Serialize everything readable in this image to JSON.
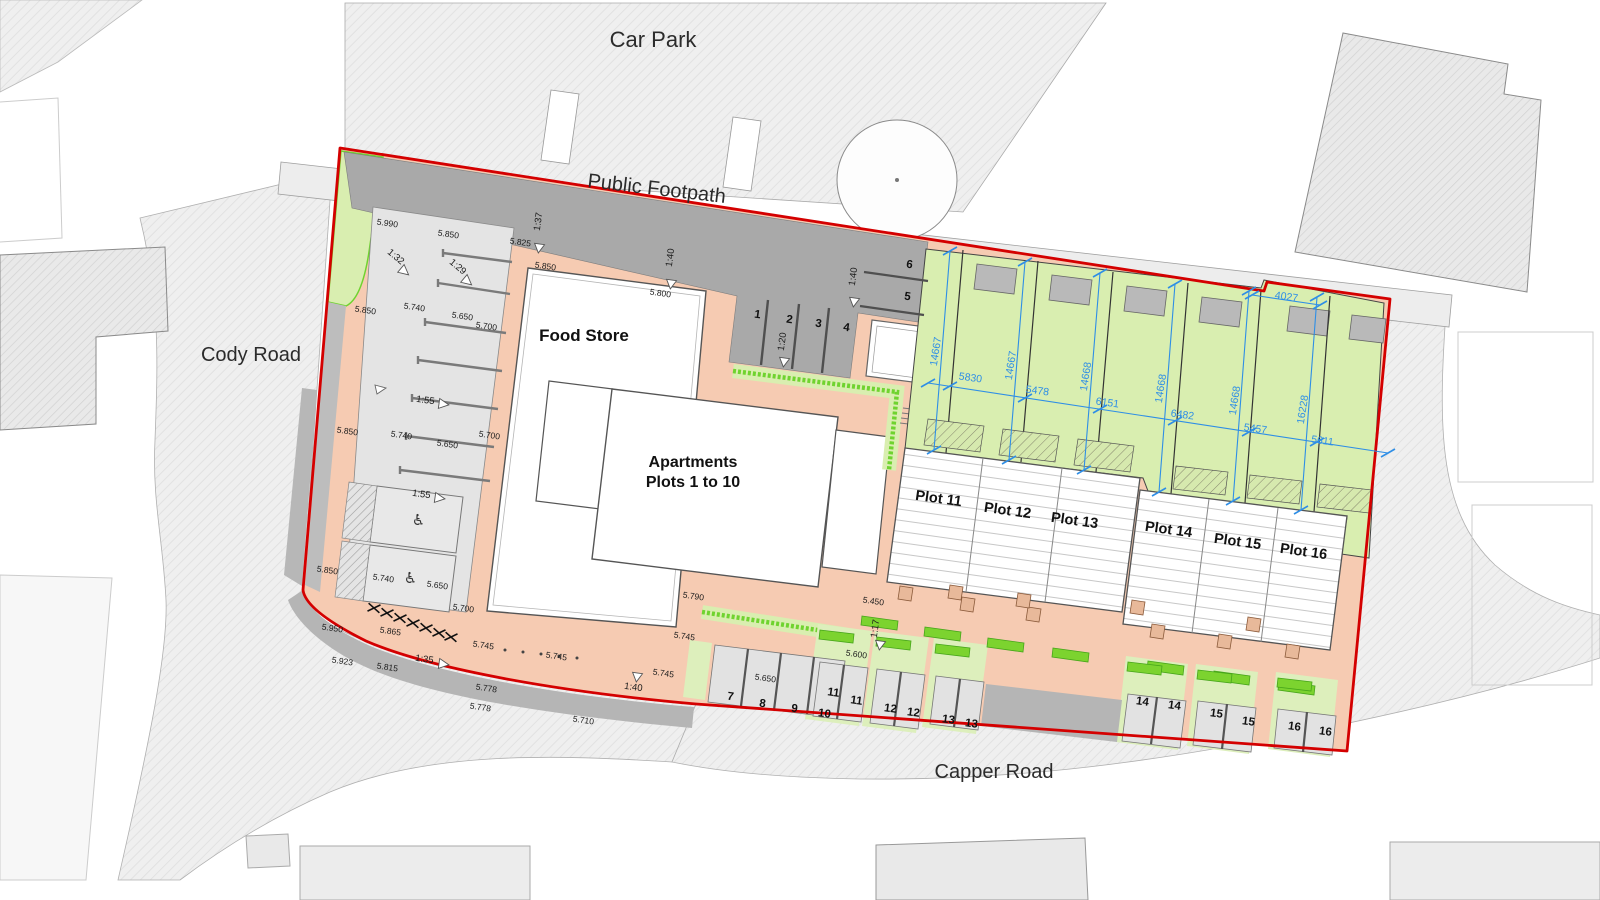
{
  "drawing": {
    "type": "site-layout-plan",
    "roads": {
      "car_park": "Car Park",
      "public_footpath": "Public Footpath",
      "cody_road": "Cody Road",
      "capper_road": "Capper Road"
    },
    "buildings": {
      "food_store": "Food Store",
      "apartments_line1": "Apartments",
      "apartments_line2": "Plots 1 to 10"
    },
    "plots": [
      "Plot 11",
      "Plot 12",
      "Plot 13",
      "Plot 14",
      "Plot 15",
      "Plot 16"
    ],
    "parking_numbers": [
      "1",
      "2",
      "3",
      "4",
      "5",
      "6",
      "7",
      "8",
      "9",
      "10",
      "11",
      "11",
      "12",
      "12",
      "13",
      "13",
      "14",
      "14",
      "15",
      "15",
      "16",
      "16"
    ],
    "spot_levels": [
      "5.990",
      "5.850",
      "5.825",
      "5.850",
      "5.800",
      "5.850",
      "5.740",
      "5.650",
      "5.700",
      "5.850",
      "5.740",
      "5.650",
      "5.700",
      "5.850",
      "5.740",
      "5.650",
      "5.700",
      "5.950",
      "5.865",
      "5.923",
      "5.815",
      "5.745",
      "5.745",
      "5.778",
      "5.778",
      "5.710",
      "5.790",
      "5.745",
      "5.450",
      "5.600",
      "5.650",
      "5.745"
    ],
    "gradients": [
      "1:37",
      "1:40",
      "1:40",
      "1:20",
      "1:32",
      "1:29",
      "1:55",
      "1:55",
      "1:35",
      "1:40",
      "1:17"
    ],
    "dimensions": {
      "vertical": [
        "14667",
        "14667",
        "14668",
        "14668",
        "14668",
        "16228"
      ],
      "horizontal": [
        "5830",
        "5478",
        "6151",
        "6482",
        "5457",
        "5611"
      ],
      "notch": "4027"
    },
    "icons": {
      "wheelchair": "♿"
    },
    "colors": {
      "boundary_red": "#d40000",
      "dimension_blue": "#2e8ee6",
      "footway_salmon": "#f6cbb2",
      "garden_green": "#d9eeb0",
      "hedge_green": "#6fd32f",
      "service_grey": "#a9a9a9"
    }
  }
}
